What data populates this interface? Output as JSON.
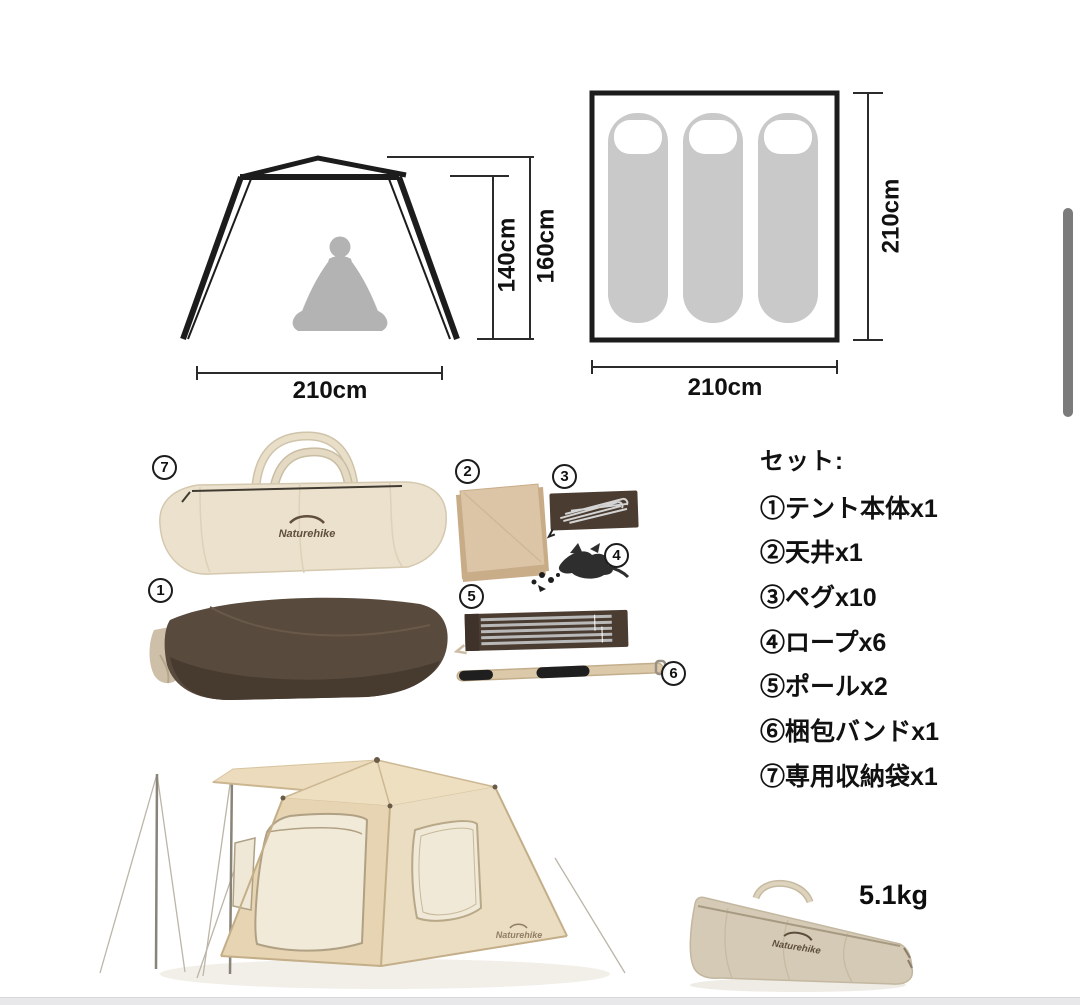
{
  "palette": {
    "cream_bag": "#ebe1cd",
    "tent_body_brown": "#584a3d",
    "case_brown": "#4a3c31",
    "tent_beige": "#e8d6b5",
    "fabric_tan": "#dbc5a6",
    "silhouette_gray": "#b3b3b3",
    "scrollbar_gray": "#7b7b7b",
    "line_black": "#1c1c1c"
  },
  "side_view_diagram": {
    "inner_height": "140cm",
    "outer_height": "160cm",
    "width": "210cm"
  },
  "floor_plan_diagram": {
    "depth": "210cm",
    "width": "210cm",
    "sleeping_bag_count": 3
  },
  "set_list": {
    "title": "セット:",
    "items": [
      {
        "label": "①テント本体x1"
      },
      {
        "label": "②天井x1"
      },
      {
        "label": "③ペグx10"
      },
      {
        "label": "④ロープx6"
      },
      {
        "label": "⑤ポールx2"
      },
      {
        "label": "⑥梱包バンドx1"
      },
      {
        "label": "⑦専用収納袋x1"
      }
    ]
  },
  "components": {
    "storage_bag_badge": "7",
    "tent_body_badge": "1",
    "ceiling_badge": "2",
    "pegs_badge": "3",
    "rope_badge": "4",
    "pole_badge": "5",
    "band_badge": "6"
  },
  "brand": {
    "logo_text": "Naturehike"
  },
  "weight_label": "5.1kg"
}
